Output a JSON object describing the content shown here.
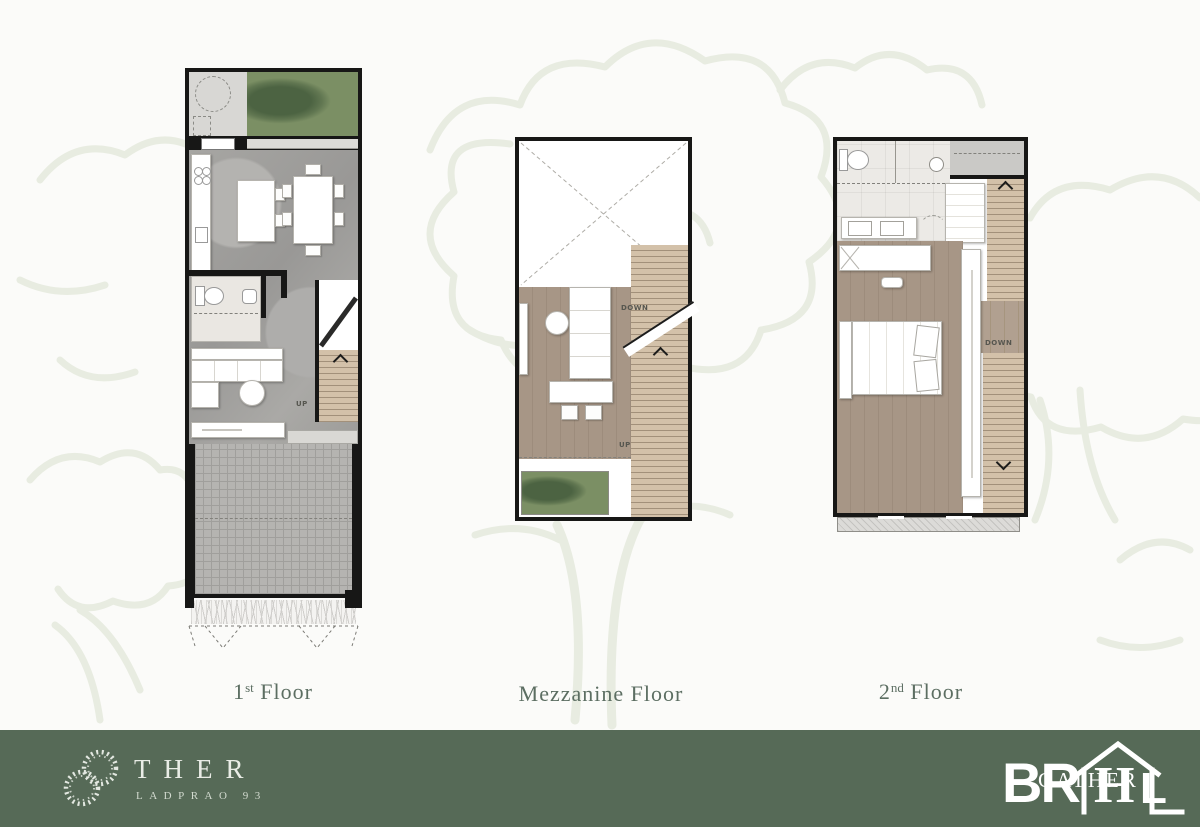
{
  "floors": [
    {
      "num": "1",
      "sup": "st",
      "name": " Floor"
    },
    {
      "num": "",
      "sup": "",
      "name": "Mezzanine Floor"
    },
    {
      "num": "2",
      "sup": "nd",
      "name": " Floor"
    }
  ],
  "annotations": {
    "up": "UP",
    "down": "DOWN"
  },
  "footer": {
    "brand": "THER",
    "brand_subtitle": "LADPRAO 93",
    "logo": {
      "bold_left": "BR",
      "serif_center": "H",
      "bold_right": "L",
      "overlay": "GATHER"
    }
  },
  "colors": {
    "footer_bg": "#566a57",
    "label_text": "#5c6e62",
    "grass": "#7b8f64",
    "wood_floor": "#a69585",
    "stair_wood": "#d2c0a8",
    "marble_floor": "#a5a4a1",
    "watermark": "#e8ece1",
    "wall": "#171716"
  }
}
